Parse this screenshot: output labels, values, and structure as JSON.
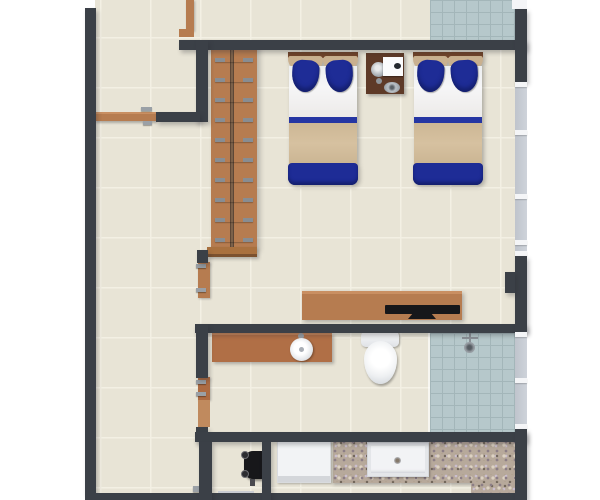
{
  "meta": {
    "title": "3D rendered floor plan, top-down view of a hotel-style guest room",
    "view": "top-down 3D render",
    "canvas": {
      "width": 600,
      "height": 500
    }
  },
  "palette": {
    "bg": "#ffffff",
    "wall": "#3b4047",
    "floor": "#e8e4d6",
    "grout": "#f3f0e4",
    "tileBlue": "#b6c8cb",
    "tileBlueLine": "#a3b6b9",
    "glass": "#ced3da",
    "frame": "#f4f5f7",
    "wood": "#b67c50",
    "woodDark": "#6f4930",
    "woodLight": "#c98f62",
    "nightstand": "#5e3a28",
    "navy": "#1e2c96",
    "navyDark": "#141f6e",
    "stripe": "#2636a3",
    "blanket": "#d6c1a0",
    "headboard": "#c9b08f",
    "fixtureWhite": "#f2f3f5",
    "graniteBase": "#b7a99b",
    "black": "#17171a",
    "metal": "#9aa0a6"
  },
  "rooms": {
    "bedroom": {
      "label": "bedroom with two twin beds"
    },
    "hallway": {
      "label": "entry hallway along left side"
    },
    "balcony": {
      "label": "blue tiled balcony, top right"
    },
    "bathroom": {
      "label": "bathroom with vanity, toilet and shower"
    },
    "shower": {
      "label": "blue tiled walk-in shower"
    },
    "utility": {
      "label": "utility closet with water heater"
    },
    "kitchen": {
      "label": "kitchenette with granite counter"
    }
  },
  "furniture": {
    "wardrobe": {
      "label": "wardrobe with hanging rail",
      "hanger_count": 10
    },
    "bed1": {
      "label": "twin bed left: navy pillows, white sheet, blue stripe, tan blanket, navy footer"
    },
    "bed2": {
      "label": "twin bed right: navy pillows, white sheet, blue stripe, tan blanket, navy footer"
    },
    "nightstand": {
      "label": "nightstand with lamp, telephone card and tray"
    },
    "tv_console": {
      "label": "wooden console with flat-screen TV"
    },
    "vanity": {
      "label": "bathroom vanity counter with round basin"
    },
    "toilet": {
      "label": "toilet with tank"
    },
    "shower_fixture": {
      "label": "overhead shower fixture"
    },
    "water_heater": {
      "label": "wall mounted water heater"
    },
    "refrigerator": {
      "label": "refrigerator"
    },
    "kitchen_counter": {
      "label": "L-shaped granite counter"
    },
    "kitchen_sink": {
      "label": "rectangular kitchen sink"
    },
    "laundry_box": {
      "label": "white appliance at bottom edge"
    }
  },
  "doors": {
    "entry": {
      "label": "entry door with handle",
      "state": "closed"
    },
    "bedroom": {
      "label": "bedroom door leaf with hinges",
      "state": "open"
    },
    "bathroom": {
      "label": "bathroom door leaf with hinges",
      "state": "open"
    },
    "top_jamb": {
      "label": "door jamb at top of hallway"
    }
  },
  "windows": {
    "right_upper": {
      "label": "window band, right wall upper",
      "mullion_count": 5
    },
    "right_lower": {
      "label": "window band along shower",
      "mullion_count": 3
    },
    "top_corner": {
      "label": "window frame, top right corner"
    }
  }
}
